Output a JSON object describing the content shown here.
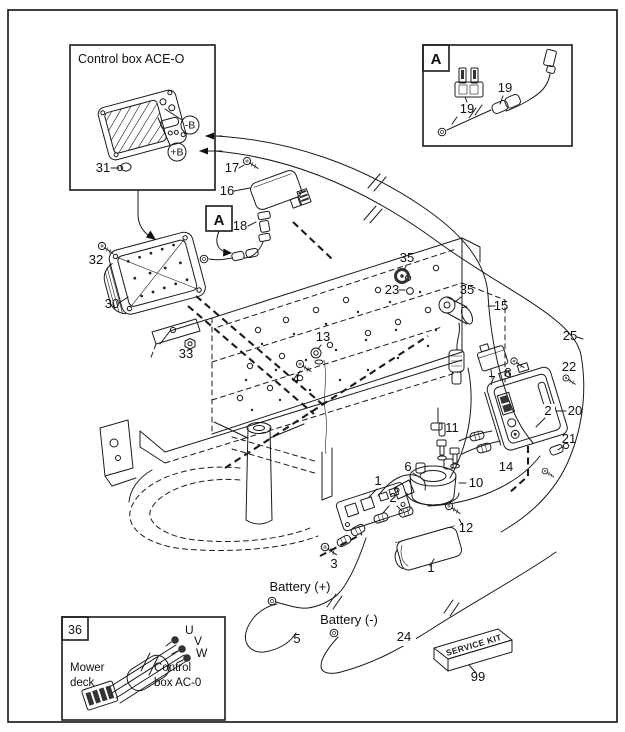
{
  "diagram": {
    "insets": {
      "control_box_ace_o": {
        "title": "Control box ACE-O",
        "minus_b": "-B",
        "plus_b": "+B",
        "callout_31": "31"
      },
      "detail_a": {
        "label": "A",
        "callout_19_fuse": "19",
        "callout_19_holder": "19"
      },
      "detail_a_marker": {
        "label": "A"
      },
      "harness_36": {
        "number": "36",
        "left_line1": "Mower",
        "left_line2": "deck",
        "right_line1": "Control",
        "right_line2": "box AC-0",
        "phase_u": "U",
        "phase_v": "V",
        "phase_w": "W"
      }
    },
    "callouts": {
      "screw_17": "17",
      "relay_16": "16",
      "connector_18": "18",
      "screw_32": "32",
      "control_box_30": "30",
      "nut_33": "33",
      "screw_23": "23",
      "grommet_35": "35",
      "switch_35": "35",
      "harness_15": "15",
      "harness_25": "25",
      "bolt_13": "13",
      "screw_4": "4",
      "relay_7": "7",
      "screw_8": "8",
      "screw_22": "22",
      "ecu_20": "20",
      "ecu_2": "2",
      "connector_21": "21",
      "harness_14": "14",
      "bolt_11": "11",
      "wire_6": "6",
      "solenoid_10": "10",
      "screw_12": "12",
      "bracket_1": "1",
      "fuse_2": "2",
      "cover_1": "1",
      "screw_3": "3",
      "cable_5": "5",
      "cable_24": "24",
      "service_kit_99": "99"
    },
    "battery": {
      "positive": "Battery (+)",
      "negative": "Battery (-)"
    },
    "service_kit_label": "SERVICE KIT",
    "colors": {
      "line": "#1b1b1b",
      "background": "#ffffff"
    }
  }
}
